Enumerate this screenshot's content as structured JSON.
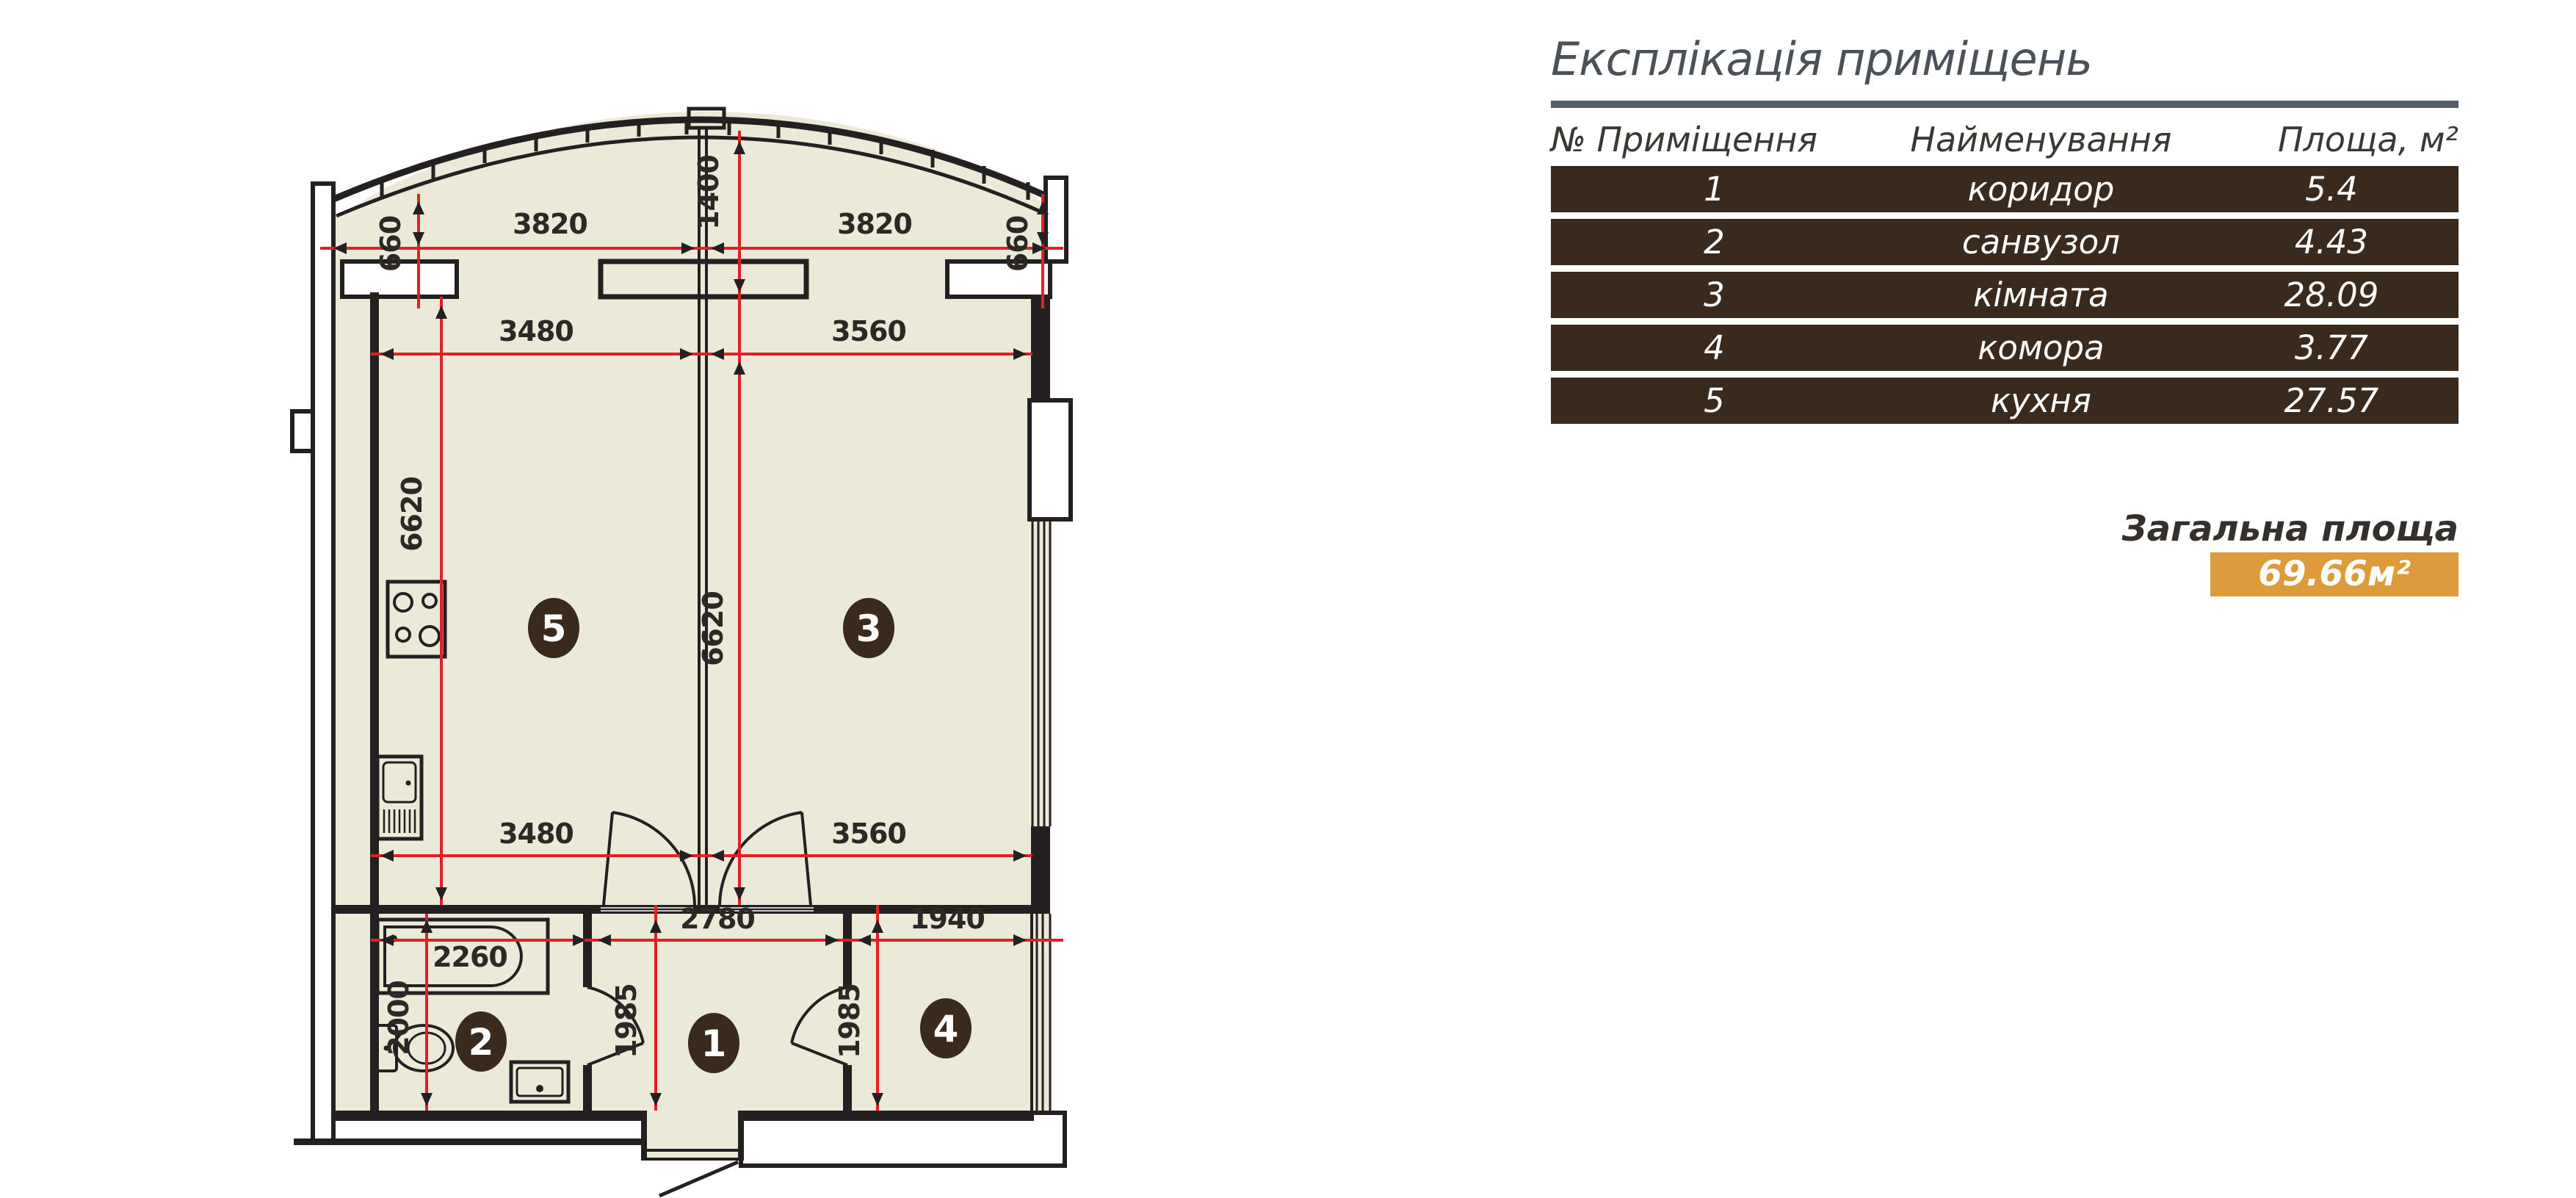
{
  "colors": {
    "floor_fill": "#ebe9d7",
    "wall": "#242021",
    "dimension_red": "#e31f26",
    "table_brown": "#3a2a1d",
    "accent_orange": "#dd9b3c",
    "title_gray": "#4b5159"
  },
  "legend_table": {
    "title": "Експлікація приміщень",
    "columns": {
      "number": "№ Приміщення",
      "name": "Найменування",
      "area": "Площа, м²"
    },
    "rows": [
      {
        "number": "1",
        "name": "коридор",
        "area": "5.4"
      },
      {
        "number": "2",
        "name": "санвузол",
        "area": "4.43"
      },
      {
        "number": "3",
        "name": "кімната",
        "area": "28.09"
      },
      {
        "number": "4",
        "name": "комора",
        "area": "3.77"
      },
      {
        "number": "5",
        "name": "кухня",
        "area": "27.57"
      }
    ],
    "total_label": "Загальна площа",
    "total_value": "69.66м²"
  },
  "plan": {
    "rooms": {
      "kitchen_number": "5",
      "living_number": "3",
      "bath_number": "2",
      "hall_number": "1",
      "storage_number": "4"
    },
    "dims": {
      "left_offset": "660",
      "right_offset": "660",
      "top_width_left": "3820",
      "top_width_right": "3820",
      "bay_depth": "1400",
      "kitchen_width_top": "3480",
      "living_width_top": "3560",
      "kitchen_height": "6620",
      "living_height": "6620",
      "kitchen_width_bottom": "3480",
      "living_width_bottom": "3560",
      "bath_length": "2260",
      "bath_depth": "2000",
      "hall_width": "2780",
      "storage_width": "1940",
      "hall_depth": "1985",
      "storage_depth": "1985"
    }
  }
}
